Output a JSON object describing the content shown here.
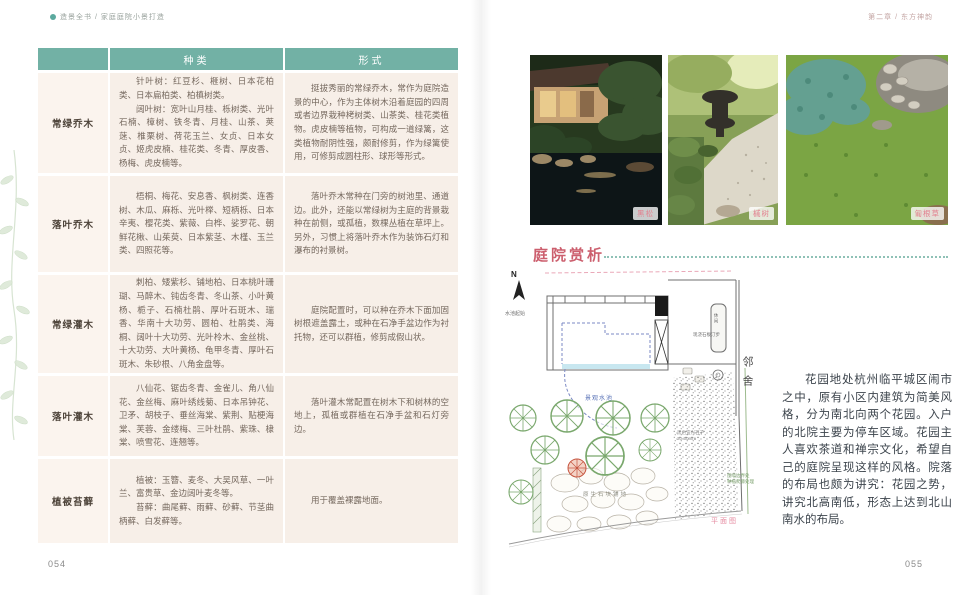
{
  "book": {
    "left_running_head": "造景全书 / 家庭庭院小景打造",
    "right_running_head": "第二章 / 东方神韵",
    "left_page_number": "054",
    "right_page_number": "055"
  },
  "table": {
    "header": {
      "species": "种类",
      "form": "形式"
    },
    "rows": [
      {
        "category": "常绿乔木",
        "species": [
          "针叶树：红豆杉、榧树、日本花柏类、日本扁柏类、柏槙树类。",
          "阔叶树：宽叶山月桂、栎树类、光叶石楠、樟树、铁冬青、月桂、山茶、荚蒾、椎栗树、荷花玉兰、女贞、日本女贞、姬虎皮楠、桂花类、冬青、厚皮香、杨梅、虎皮楠等。"
        ],
        "form": "挺拔秀丽的常绿乔木，常作为庭院造景的中心，作为主体树木沿着庭园的四周或者边界栽种栲树类、山茶类、桂花类植物。虎皮楠等植物，可构成一道绿篱，这类植物耐阴性强，颇耐修剪，作为绿篱使用，可修剪成圆柱形、球形等形式。"
      },
      {
        "category": "落叶乔木",
        "species": [
          "梧桐、梅花、安息香、枫树类、连香树、木瓜、麻栎、光叶榉、短柄栎、日本辛夷、樱花类、紫薇、白桦、娑罗花、朝鲜花楸、山茱萸、日本紫茎、木槿、玉兰类、四照花等。"
        ],
        "form": "落叶乔木常种在门旁的树池里、通道边。此外，还能以常绿树为主庭的背景栽种在前侧，或孤植，数棵丛植在草坪上。另外，习惯上将落叶乔木作为装饰石灯和瀑布的衬景树。"
      },
      {
        "category": "常绿灌木",
        "species": [
          "刺柏、矮紫杉、铺地柏、日本桃叶珊瑚、马醉木、钝齿冬青、冬山茶、小叶黄杨、栀子、石楠杜鹃、厚叶石斑木、瑞香、华南十大功劳、圆柏、杜鹃类、海桐、阔叶十大功劳、光叶柃木、金丝桃、十大功劳、大叶黄杨、龟甲冬青、厚叶石斑木、朱砂根、八角金盘等。"
        ],
        "form": "庭院配置时，可以种在乔木下面加固树根遮盖露土，或种在石净手盆边作为衬托物，还可以群植，修剪成假山状。"
      },
      {
        "category": "落叶灌木",
        "species": [
          "八仙花、锯齿冬青、金雀儿、角八仙花、金丝梅、麻叶绣线菊、日本吊钟花、卫矛、胡枝子、垂丝海棠、紫荆、贴梗海棠、芙蓉、金缕梅、三叶杜鹃、紫珠、棣棠、喷雪花、连翘等。"
        ],
        "form": "落叶灌木常配置在树木下和树林的空地上，孤植或群植在石净手盆和石灯旁边。"
      },
      {
        "category": "植被苔藓",
        "species": [
          "植被：玉簪、麦冬、大吴风草、一叶兰、富贵草、金边阔叶麦冬等。",
          "苔藓：曲尾藓、雨藓、砂藓、节茎曲柄藓、白发藓等。"
        ],
        "form": "用于覆盖裸露地面。"
      }
    ]
  },
  "photos": [
    {
      "label": "黑松"
    },
    {
      "label": "槭树"
    },
    {
      "label": "匍根草"
    }
  ],
  "section": {
    "title": "庭院赏析"
  },
  "plan": {
    "labels": {
      "north": "N",
      "pool_start": "水池起始",
      "pool": "景观水池",
      "steps": "现浇石板汀步",
      "leisure": "休闲",
      "neighbor": "邻舍",
      "stone_paving": "原生石块铺地",
      "gravel_line1": "黑色宜兴石子",
      "gravel_line2": "30-50mm",
      "vine_line1": "围墙边界处",
      "vine_line2": "种植爬藤处理",
      "caption": "平面图"
    }
  },
  "essay": "花园地处杭州临平城区闹市之中，原有小区内建筑为简美风格，分为南北向两个花园。入户的北院主要为停车区域。花园主人喜欢茶道和禅宗文化，希望自己的庭院呈现这样的风格。院落的布局也颇为讲究：花园之势，讲究北高南低，形态上达到北山南水的布局。",
  "colors": {
    "table_header_teal": "#72b1a5",
    "table_cell_bg": "#f7efe8",
    "category_cell_bg": "#fbf4ee",
    "body_text": "#75685e",
    "heading_pink": "#cc5f6e",
    "photo_label_pink": "#e2808f",
    "plan_water_blue": "#7b89c4",
    "plan_tree_green": "#7aa86d",
    "caption_pink": "#e58ba0"
  }
}
